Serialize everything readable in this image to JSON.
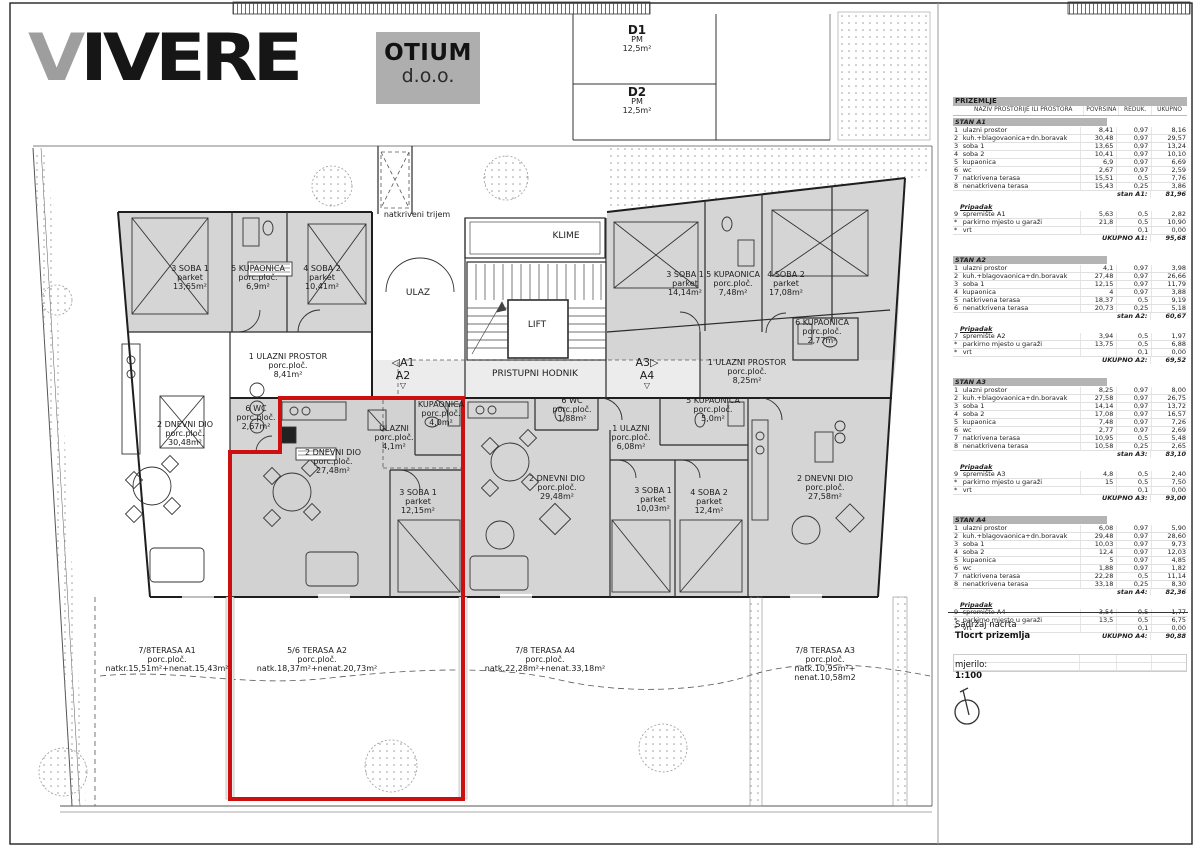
{
  "logo": {
    "brand_first": "V",
    "brand_rest": "IVERE",
    "box_line1": "OTIUM",
    "box_line2": "d.o.o."
  },
  "parking": {
    "d1": [
      "D1",
      "PM",
      "12,5m²"
    ],
    "d2": [
      "D2",
      "PM",
      "12,5m²"
    ]
  },
  "plan": {
    "labels": {
      "trijem": "natkriveni trijem",
      "klime": "KLIME",
      "ulaz": "ULAZ",
      "lift": "LIFT",
      "hodnik": "PRISTUPNI HODNIK"
    },
    "markers": {
      "left": [
        "◁A1",
        "A2",
        "▽"
      ],
      "right": [
        "A3▷",
        "A4",
        "▽"
      ]
    },
    "rooms": {
      "a1_soba1": [
        "3 SOBA 1",
        "parket",
        "13,65m²"
      ],
      "a1_kupa": [
        "5 KUPAONICA",
        "porc.ploč.",
        "6,9m²"
      ],
      "a1_soba2": [
        "4 SOBA 2",
        "parket",
        "10,41m²"
      ],
      "a1_ulazni": [
        "1 ULAZNI PROSTOR",
        "porc.ploč.",
        "8,41m²"
      ],
      "a1_wc": [
        "6 WC",
        "porc.ploč.",
        "2,67m²"
      ],
      "a1_dnevni": [
        "2 DNEVNI DIO",
        "porc.ploč.",
        "30,48m²"
      ],
      "a2_dnevni": [
        "2 DNEVNI DIO",
        "porc.ploč.",
        "27,48m²"
      ],
      "a2_ulazni": [
        "ULAZNI",
        "porc.ploč.",
        "4,1m²"
      ],
      "a2_kupa": [
        "KUPAONICA",
        "porc.ploč.",
        "4,0m²"
      ],
      "a2_soba1": [
        "3 SOBA 1",
        "parket",
        "12,15m²"
      ],
      "a4_wc": [
        "6 WC",
        "porc.ploč.",
        "1,88m²"
      ],
      "a4_ulazni": [
        "1 ULAZNI",
        "porc.ploč.",
        "6,08m²"
      ],
      "a4_kupa": [
        "5 KUPAONICA",
        "porc.ploč.",
        "5,0m²"
      ],
      "a4_dnevni": [
        "2 DNEVNI DIO",
        "porc.ploč.",
        "29,48m²"
      ],
      "a4_soba1": [
        "3 SOBA 1",
        "parket",
        "10,03m²"
      ],
      "a4_soba2": [
        "4 SOBA 2",
        "parket",
        "12,4m²"
      ],
      "a3_soba1": [
        "3 SOBA 1",
        "parket",
        "14,14m²"
      ],
      "a3_kupa": [
        "5 KUPAONICA",
        "porc.ploč.",
        "7,48m²"
      ],
      "a3_soba2": [
        "4 SOBA 2",
        "parket",
        "17,08m²"
      ],
      "a3_kupa6": [
        "6 KUPAONICA",
        "porc.ploč.",
        "2,77m²"
      ],
      "a3_ulazni": [
        "1 ULAZNI PROSTOR",
        "porc.ploč.",
        "8,25m²"
      ],
      "a3_dnevni": [
        "2 DNEVNI DIO",
        "porc.ploč.",
        "27,58m²"
      ]
    },
    "terraces": {
      "a1": [
        "7/8TERASA A1",
        "porc.ploč.",
        "natkr.15,51m²+nenat.15,43m²"
      ],
      "a2": [
        "5/6 TERASA A2",
        "porc.ploč.",
        "natk.18,37m²+nenat.20,73m²"
      ],
      "a4": [
        "7/8 TERASA A4",
        "porc.ploč.",
        "natk.22,28m²+nenat.33,18m²"
      ],
      "a3": [
        "7/8 TERASA A3",
        "porc.ploč.",
        "natk.10,95m²+",
        "nenat.10,58m2"
      ]
    }
  },
  "table": {
    "title": "PRIZEMLJE",
    "headers": [
      "NAZIV PROSTORIJE ILI PROSTORA",
      "POVRŠINA (m2)",
      "REDUK. KOEF.",
      "UKUPNO (m2)"
    ],
    "sections": [
      {
        "name": "STAN A1",
        "rows": [
          [
            "1",
            "ulazni prostor",
            "8,41",
            "0,97",
            "8,16"
          ],
          [
            "2",
            "kuh.+blagovaonica+dn.boravak",
            "30,48",
            "0,97",
            "29,57"
          ],
          [
            "3",
            "soba 1",
            "13,65",
            "0,97",
            "13,24"
          ],
          [
            "4",
            "soba 2",
            "10,41",
            "0,97",
            "10,10"
          ],
          [
            "5",
            "kupaonica",
            "6,9",
            "0,97",
            "6,69"
          ],
          [
            "6",
            "wc",
            "2,67",
            "0,97",
            "2,59"
          ],
          [
            "7",
            "natkrivena terasa",
            "15,51",
            "0,5",
            "7,76"
          ],
          [
            "8",
            "nenatkrivena terasa",
            "15,43",
            "0,25",
            "3,86"
          ]
        ],
        "subtotal_label": "stan A1:",
        "subtotal": "81,96",
        "pripadak_label": "Pripadak",
        "pripadak_rows": [
          [
            "9",
            "spremište A1",
            "5,63",
            "0,5",
            "2,82"
          ],
          [
            "*",
            "parkirno mjesto u garaži",
            "21,8",
            "0,5",
            "10,90"
          ],
          [
            "*",
            "vrt",
            "",
            "0,1",
            "0,00"
          ]
        ],
        "total_label": "UKUPNO A1:",
        "total": "95,68"
      },
      {
        "name": "STAN A2",
        "rows": [
          [
            "1",
            "ulazni prostor",
            "4,1",
            "0,97",
            "3,98"
          ],
          [
            "2",
            "kuh.+blagovaonica+dn.boravak",
            "27,48",
            "0,97",
            "26,66"
          ],
          [
            "3",
            "soba 1",
            "12,15",
            "0,97",
            "11,79"
          ],
          [
            "4",
            "kupaonica",
            "4",
            "0,97",
            "3,88"
          ],
          [
            "5",
            "natkrivena terasa",
            "18,37",
            "0,5",
            "9,19"
          ],
          [
            "6",
            "nenatkrivena terasa",
            "20,73",
            "0,25",
            "5,18"
          ]
        ],
        "subtotal_label": "stan A2:",
        "subtotal": "60,67",
        "pripadak_label": "Pripadak",
        "pripadak_rows": [
          [
            "7",
            "spremište A2",
            "3,94",
            "0,5",
            "1,97"
          ],
          [
            "*",
            "parkirno mjesto u garaži",
            "13,75",
            "0,5",
            "6,88"
          ],
          [
            "*",
            "vrt",
            "",
            "0,1",
            "0,00"
          ]
        ],
        "total_label": "UKUPNO A2:",
        "total": "69,52"
      },
      {
        "name": "STAN A3",
        "rows": [
          [
            "1",
            "ulazni prostor",
            "8,25",
            "0,97",
            "8,00"
          ],
          [
            "2",
            "kuh.+blagovaonica+dn.boravak",
            "27,58",
            "0,97",
            "26,75"
          ],
          [
            "3",
            "soba 1",
            "14,14",
            "0,97",
            "13,72"
          ],
          [
            "4",
            "soba 2",
            "17,08",
            "0,97",
            "16,57"
          ],
          [
            "5",
            "kupaonica",
            "7,48",
            "0,97",
            "7,26"
          ],
          [
            "6",
            "wc",
            "2,77",
            "0,97",
            "2,69"
          ],
          [
            "7",
            "natkrivena terasa",
            "10,95",
            "0,5",
            "5,48"
          ],
          [
            "8",
            "nenatkrivena terasa",
            "10,58",
            "0,25",
            "2,65"
          ]
        ],
        "subtotal_label": "stan A3:",
        "subtotal": "83,10",
        "pripadak_label": "Pripadak",
        "pripadak_rows": [
          [
            "9",
            "spremište A3",
            "4,8",
            "0,5",
            "2,40"
          ],
          [
            "*",
            "parkirno mjesto u garaži",
            "15",
            "0,5",
            "7,50"
          ],
          [
            "*",
            "vrt",
            "",
            "0,1",
            "0,00"
          ]
        ],
        "total_label": "UKUPNO A3:",
        "total": "93,00"
      },
      {
        "name": "STAN A4",
        "rows": [
          [
            "1",
            "ulazni prostor",
            "6,08",
            "0,97",
            "5,90"
          ],
          [
            "2",
            "kuh.+blagovaonica+dn.boravak",
            "29,48",
            "0,97",
            "28,60"
          ],
          [
            "3",
            "soba 1",
            "10,03",
            "0,97",
            "9,73"
          ],
          [
            "4",
            "soba 2",
            "12,4",
            "0,97",
            "12,03"
          ],
          [
            "5",
            "kupaonica",
            "5",
            "0,97",
            "4,85"
          ],
          [
            "6",
            "wc",
            "1,88",
            "0,97",
            "1,82"
          ],
          [
            "7",
            "natkrivena terasa",
            "22,28",
            "0,5",
            "11,14"
          ],
          [
            "8",
            "nenatkrivena terasa",
            "33,18",
            "0,25",
            "8,30"
          ]
        ],
        "subtotal_label": "stan A4:",
        "subtotal": "82,36",
        "pripadak_label": "Pripadak",
        "pripadak_rows": [
          [
            "9",
            "spremište A4",
            "3,54",
            "0,5",
            "1,77"
          ],
          [
            "*",
            "parkirno mjesto u garaži",
            "13,5",
            "0,5",
            "6,75"
          ],
          [
            "*",
            "vrt",
            "",
            "0,1",
            "0,00"
          ]
        ],
        "total_label": "UKUPNO A4:",
        "total": "90,88"
      }
    ]
  },
  "titleblock": {
    "content_label": "Sadržaj nacrta",
    "content": "Tlocrt prizemlja",
    "scale_label": "mjerilo:",
    "scale": "1:100"
  },
  "colors": {
    "highlight": "#cc1010",
    "room_fill": "#d5d5d5",
    "band": "#b4b4b4"
  }
}
